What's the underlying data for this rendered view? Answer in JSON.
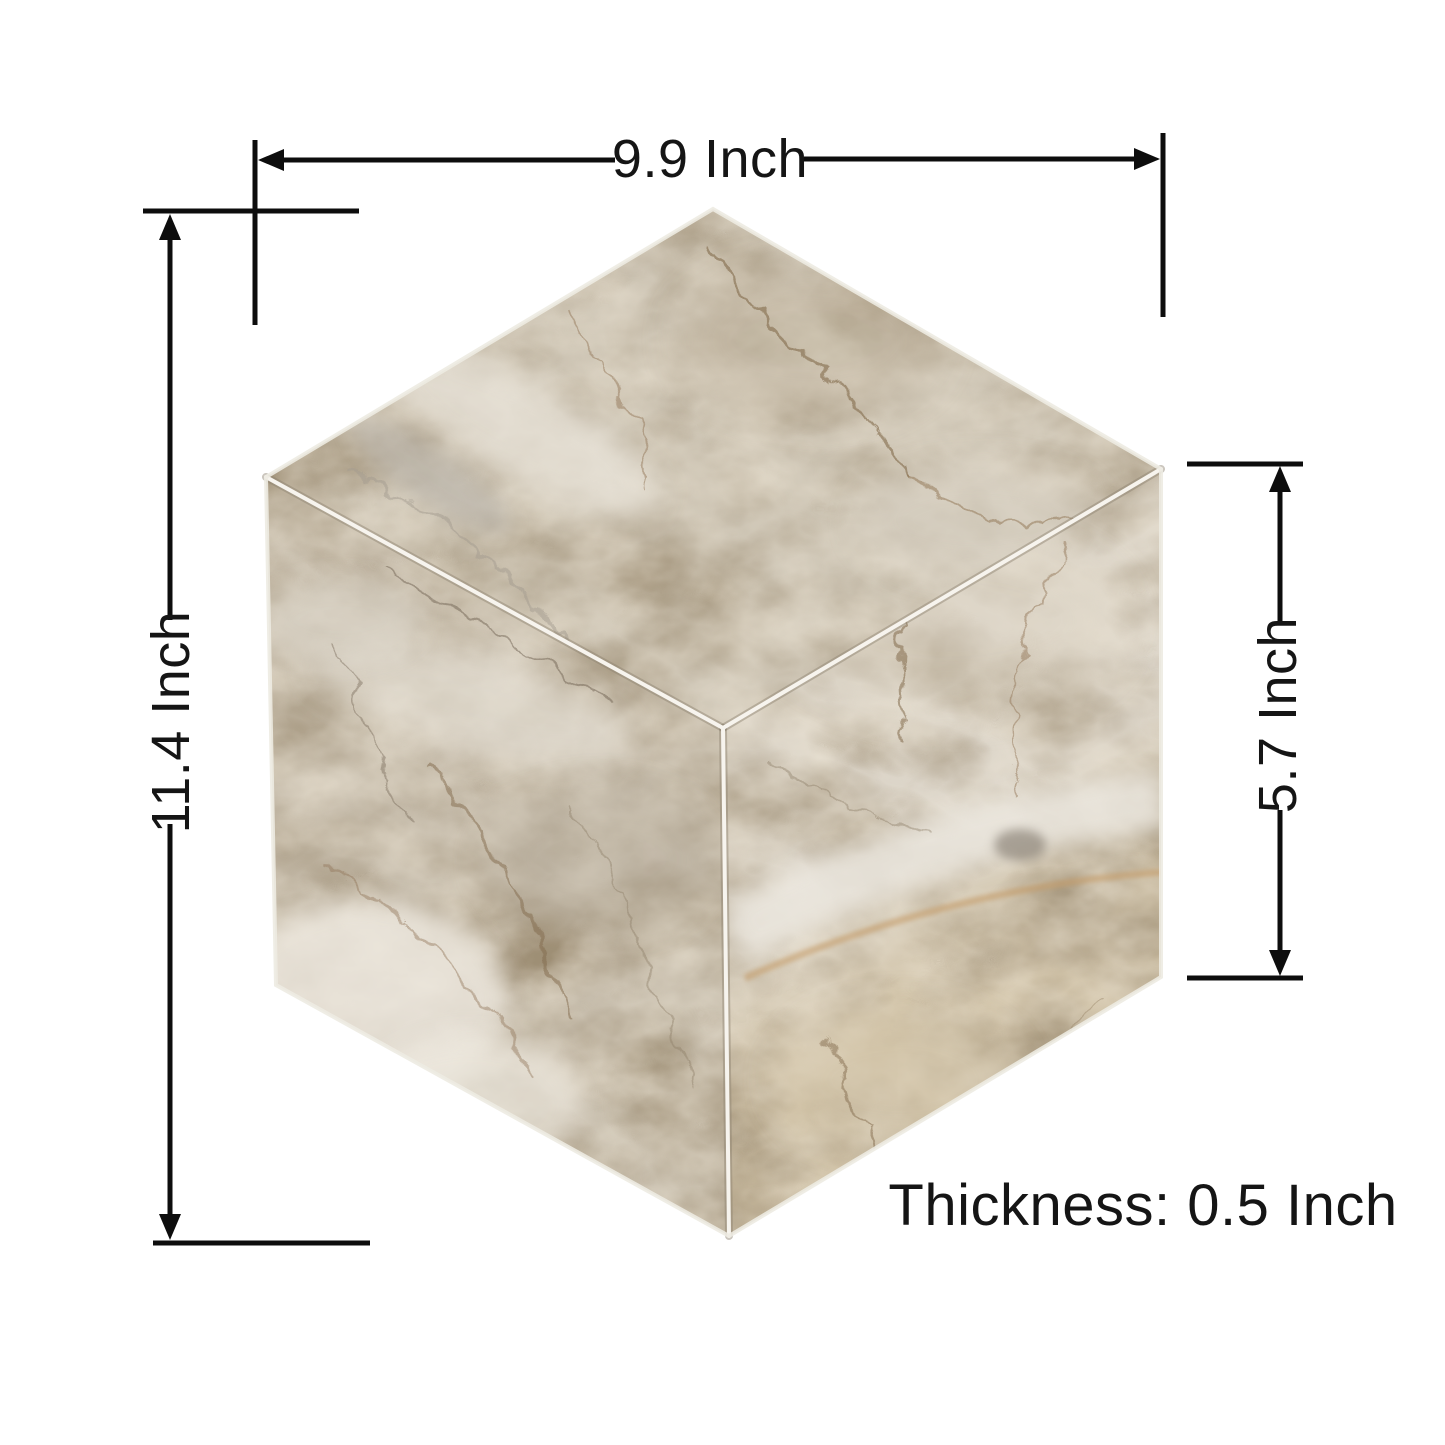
{
  "dimensions": {
    "width_label": "9.9 Inch",
    "height_label": "11.4 Inch",
    "side_height_label": "5.7 Inch",
    "thickness_label": "Thickness: 0.5 Inch"
  },
  "tile": {
    "shape": "hexagon-cube-illusion",
    "material": "beige-marble-mosaic"
  },
  "colors": {
    "background": "#ffffff",
    "dimension_line": "#0d0d0d",
    "label_text": "#151515",
    "marble_top": "#cdc4b3",
    "marble_left": "#c7bdac",
    "marble_right": "#d6cdbd",
    "marble_light": "#ebe6dc",
    "marble_dark": "#a2967f",
    "vein_brown": "#826檔a4c",
    "vein_rust": "#c49a66",
    "grout": "#f7f4ee"
  }
}
